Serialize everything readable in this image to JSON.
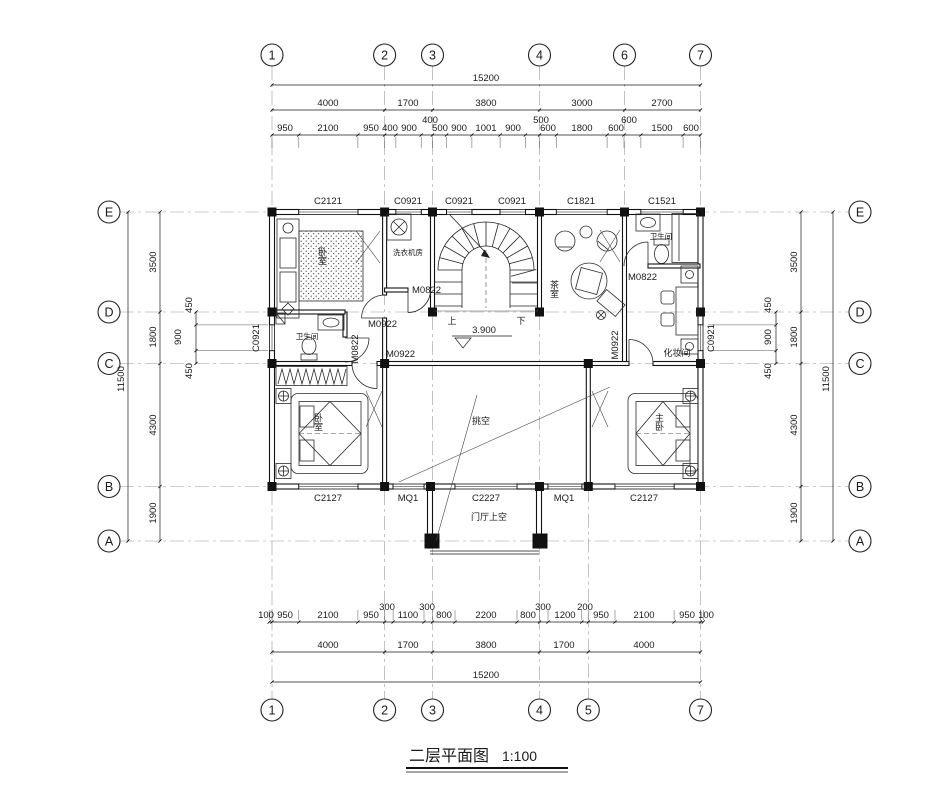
{
  "title": {
    "name": "二层平面图",
    "scale": "1:100"
  },
  "axes": {
    "top": [
      "1",
      "2",
      "3",
      "4",
      "6",
      "7"
    ],
    "bottom": [
      "1",
      "2",
      "3",
      "4",
      "5",
      "7"
    ],
    "left": [
      "E",
      "D",
      "C",
      "B",
      "A"
    ],
    "right": [
      "E",
      "D",
      "C",
      "B",
      "A"
    ]
  },
  "dims": {
    "top_overall": "15200",
    "top_segments": [
      "4000",
      "1700",
      "3800",
      "3000",
      "2700"
    ],
    "top_details": [
      "950",
      "2100",
      "950",
      "400",
      "900",
      "400",
      "500",
      "900",
      "1001",
      "900",
      "500",
      "600",
      "1800",
      "600",
      "600",
      "1500",
      "600"
    ],
    "bottom_overall": "15200",
    "bottom_segments": [
      "4000",
      "1700",
      "3800",
      "1700",
      "4000"
    ],
    "bottom_details": [
      "100",
      "950",
      "2100",
      "950",
      "300",
      "1100",
      "300",
      "800",
      "2200",
      "800",
      "300",
      "1200",
      "200",
      "950",
      "2100",
      "950",
      "100"
    ],
    "left_overall": "11500",
    "left_segments": [
      "3500",
      "1800",
      "4300",
      "1900"
    ],
    "left_details": [
      "450",
      "900",
      "450"
    ],
    "right_overall": "11500",
    "right_segments": [
      "3500",
      "1800",
      "4300",
      "1900"
    ],
    "right_details": [
      "450",
      "900",
      "450"
    ]
  },
  "openings": {
    "top_windows": [
      "C2121",
      "C0921",
      "C0921",
      "C0921",
      "C1821",
      "C1521"
    ],
    "bottom_windows": [
      "C2127",
      "MQ1",
      "C2227",
      "MQ1",
      "C2127"
    ],
    "left_window": "C0921",
    "right_window": "C0921",
    "doors": {
      "hall_upper": "M0922",
      "bath_left_leaf": "M0822",
      "hall_lower": "M0922",
      "laundry": "M0822",
      "bath_right": "M0822",
      "dressing": "M0922"
    }
  },
  "rooms": {
    "bedroom_top_left": "卧室",
    "laundry": "洗衣机房",
    "bath_left": "卫生间",
    "tea_room": "茶室",
    "bath_right": "卫生间",
    "dressing_room": "化妆间",
    "bedroom_bottom_left": "卧室",
    "master_bedroom": "主卧",
    "void": "挑空",
    "foyer_void": "门厅上空"
  },
  "annotations": {
    "up": "上",
    "down": "下",
    "elevation": "3.900"
  }
}
